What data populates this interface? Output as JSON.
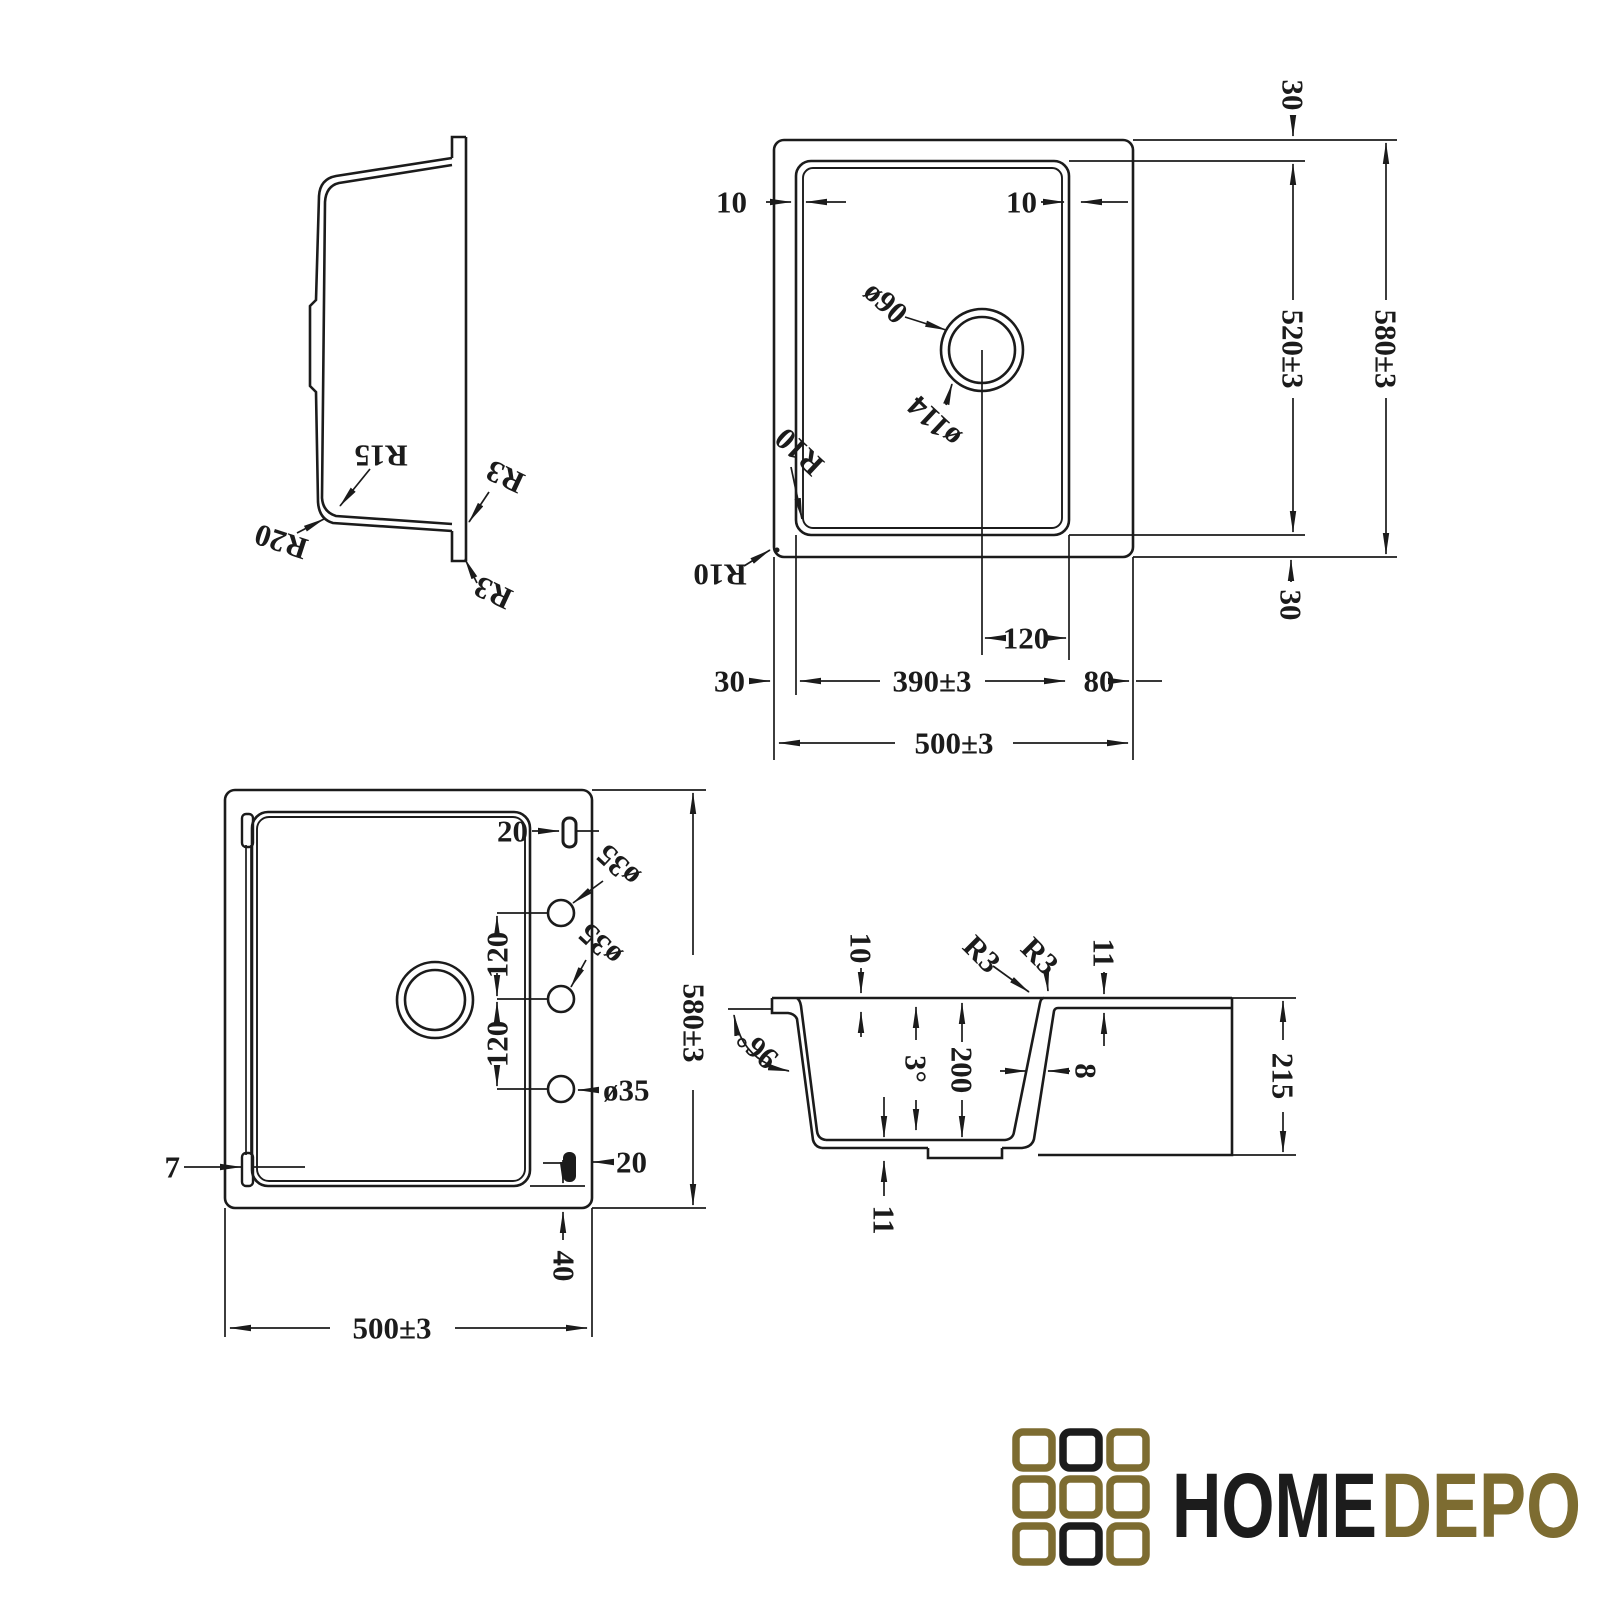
{
  "colors": {
    "line": "#1b1b1b",
    "gold": "#7d6c31",
    "black": "#1c1c1c",
    "background": "#ffffff"
  },
  "side_view": {
    "r15": "R15",
    "r20": "R20",
    "r3_upper": "R3",
    "r3_lower": "R3"
  },
  "top_view": {
    "rim_gap_left": "10",
    "rim_gap_right": "10",
    "top_margin": "30",
    "bowl_length": "520±3",
    "overall_length": "580±3",
    "bottom_margin": "30",
    "drain_hole": "ø90",
    "drain_recess": "ø114",
    "corner_radius_inner": "R10",
    "corner_radius_outer": "R10",
    "drain_offset": "120",
    "left_margin": "30",
    "bowl_width": "390±3",
    "right_margin": "80",
    "overall_width": "500±3"
  },
  "bottom_view": {
    "clip_top": "20",
    "tap_hole_1": "ø35",
    "tap_hole_2": "ø35",
    "tap_spacing_1": "120",
    "tap_spacing_2": "120",
    "tap_hole_3": "ø35",
    "overall_length": "580±3",
    "edge_lip": "7",
    "clip_bottom": "20",
    "base_inset": "40",
    "overall_width": "500±3"
  },
  "section_view": {
    "rim_width": "10",
    "rim_radius_left": "R3",
    "rim_radius_right": "R3",
    "rim_thickness": "11",
    "outer_wall_angle": "96°",
    "draft_angle": "3°",
    "bowl_depth": "200",
    "wall_thickness": "8",
    "overall_height": "215",
    "base_thickness": "11"
  },
  "logo": {
    "home": "HOME",
    "depo": "DEPO",
    "grid": [
      [
        "gold",
        "black",
        "gold"
      ],
      [
        "gold",
        "gold",
        "gold"
      ],
      [
        "gold",
        "black",
        "gold"
      ]
    ]
  }
}
